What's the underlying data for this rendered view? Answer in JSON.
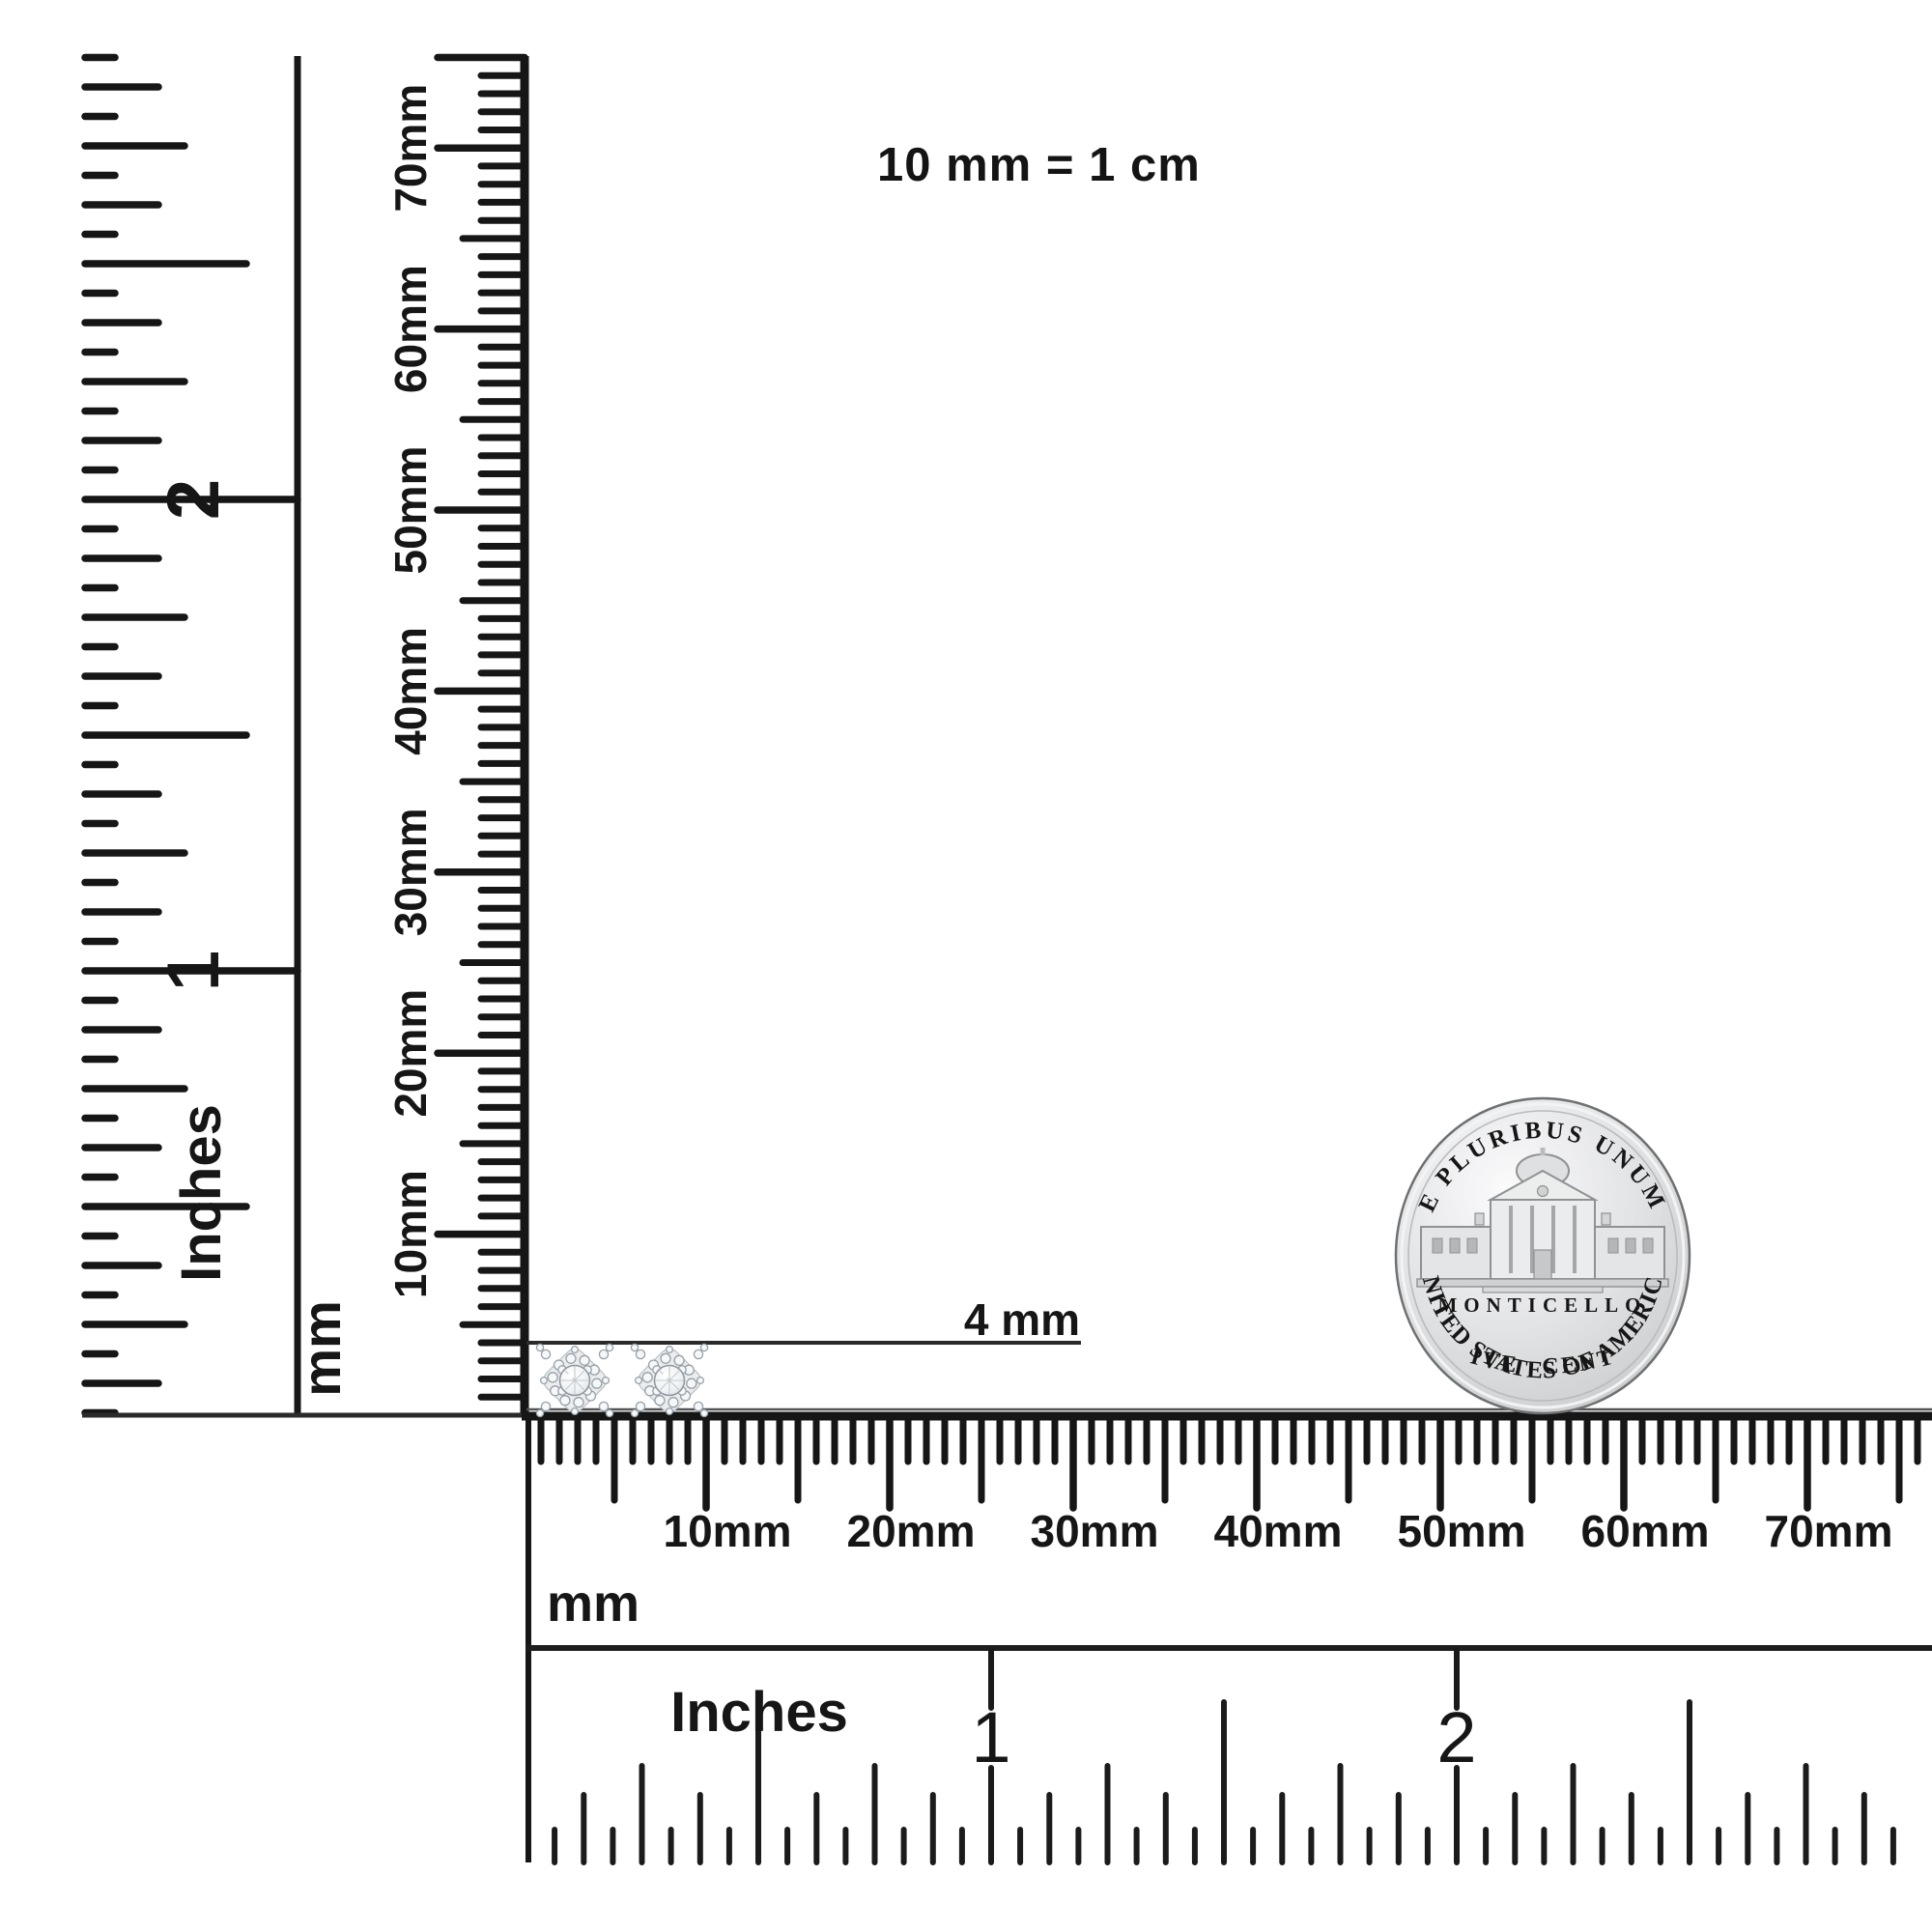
{
  "scale_note": "10 mm = 1 cm",
  "size_annotation": "4 mm",
  "left_inch_ruler": {
    "unit": "Inches",
    "numerals": [
      "1",
      "2"
    ]
  },
  "left_mm_ruler": {
    "unit": "mm",
    "labels": [
      "10mm",
      "20mm",
      "30mm",
      "40mm",
      "50mm",
      "60mm",
      "70mm"
    ]
  },
  "bottom_mm_ruler": {
    "unit": "mm",
    "labels": [
      "10mm",
      "20mm",
      "30mm",
      "40mm",
      "50mm",
      "60mm",
      "70mm"
    ]
  },
  "bottom_inch_ruler": {
    "unit": "Inches",
    "numerals": [
      "1",
      "2"
    ]
  },
  "coin": {
    "legend_top": "E PLURIBUS UNUM",
    "building_label": "MONTICELLO",
    "denomination": "FIVE CENTS",
    "legend_bottom": "UNITED STATES OF AMERICA"
  },
  "earrings": {
    "name": "diamond-cluster-stud-earrings",
    "count": 2
  },
  "colors": {
    "ink": "#161616",
    "coin_face": "#d9dadb",
    "coin_text": "#4f5356"
  }
}
